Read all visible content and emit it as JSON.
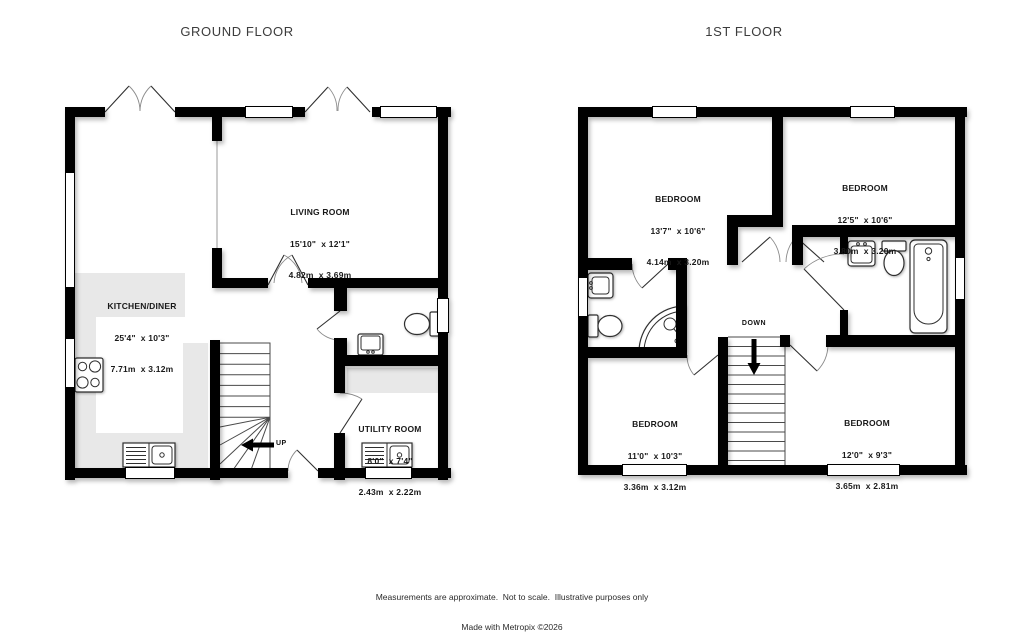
{
  "titles": {
    "ground": "GROUND FLOOR",
    "first": "1ST FLOOR"
  },
  "ground": {
    "rooms": [
      {
        "name": "LIVING ROOM",
        "imperial": "15'10\"  x 12'1\"",
        "metric": "4.82m  x 3.69m"
      },
      {
        "name": "KITCHEN/DINER",
        "imperial": "25'4\"  x 10'3\"",
        "metric": "7.71m  x 3.12m"
      },
      {
        "name": "UTILITY ROOM",
        "imperial": "8'0\"  x 7'4\"",
        "metric": "2.43m  x 2.22m"
      }
    ],
    "stairs_label": "UP"
  },
  "first": {
    "rooms": [
      {
        "name": "BEDROOM",
        "imperial": "13'7\"  x 10'6\"",
        "metric": "4.14m  x 3.20m"
      },
      {
        "name": "BEDROOM",
        "imperial": "12'5\"  x 10'6\"",
        "metric": "3.80m  x 3.20m"
      },
      {
        "name": "BEDROOM",
        "imperial": "11'0\"  x 10'3\"",
        "metric": "3.36m  x 3.12m"
      },
      {
        "name": "BEDROOM",
        "imperial": "12'0\"  x 9'3\"",
        "metric": "3.65m  x 2.81m"
      }
    ],
    "stairs_label": "DOWN"
  },
  "footer": {
    "line1": "Measurements are approximate.  Not to scale.  Illustrative purposes only",
    "line2": "Made with Metropix ©2026"
  },
  "colors": {
    "wall": "#000000",
    "counter": "#e8e8e8",
    "background": "#ffffff"
  }
}
